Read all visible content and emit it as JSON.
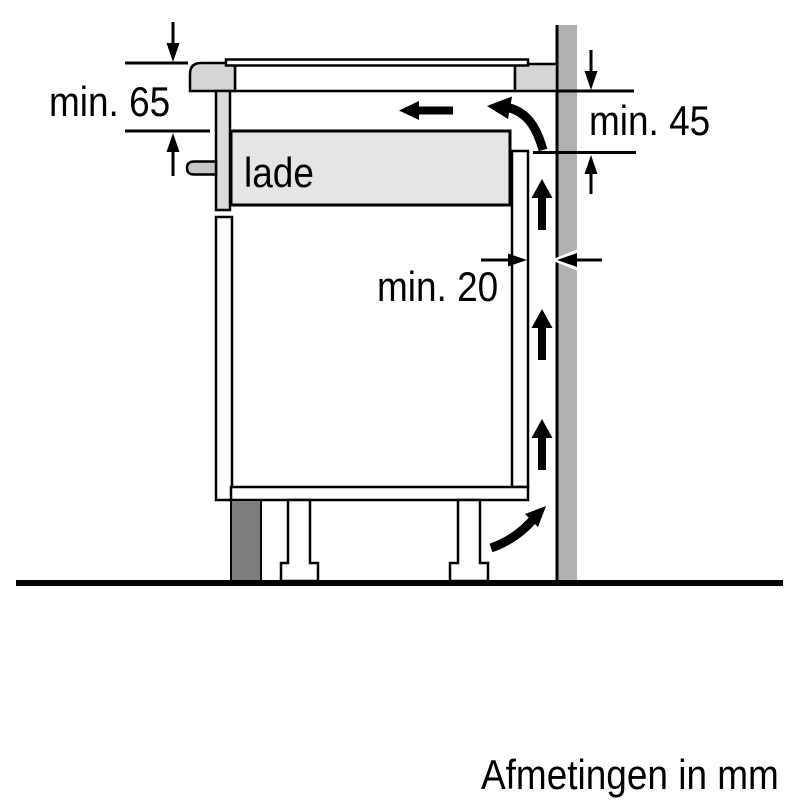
{
  "diagram": {
    "title_hint": "hob installation clearance side view",
    "labels": {
      "min65": "min. 65",
      "min45": "min. 45",
      "min20": "min. 20",
      "drawer": "lade"
    },
    "footer": "Afmetingen in mm",
    "colors": {
      "outline": "#000000",
      "background": "#ffffff",
      "wall": "#b0b0b0",
      "plinth": "#7d7d7d",
      "hob_trim": "#d5d5d5",
      "hob_front": "#dcdcdc",
      "drawer_fill": "#e5e5e5",
      "knob": "#c8c8c8"
    }
  }
}
